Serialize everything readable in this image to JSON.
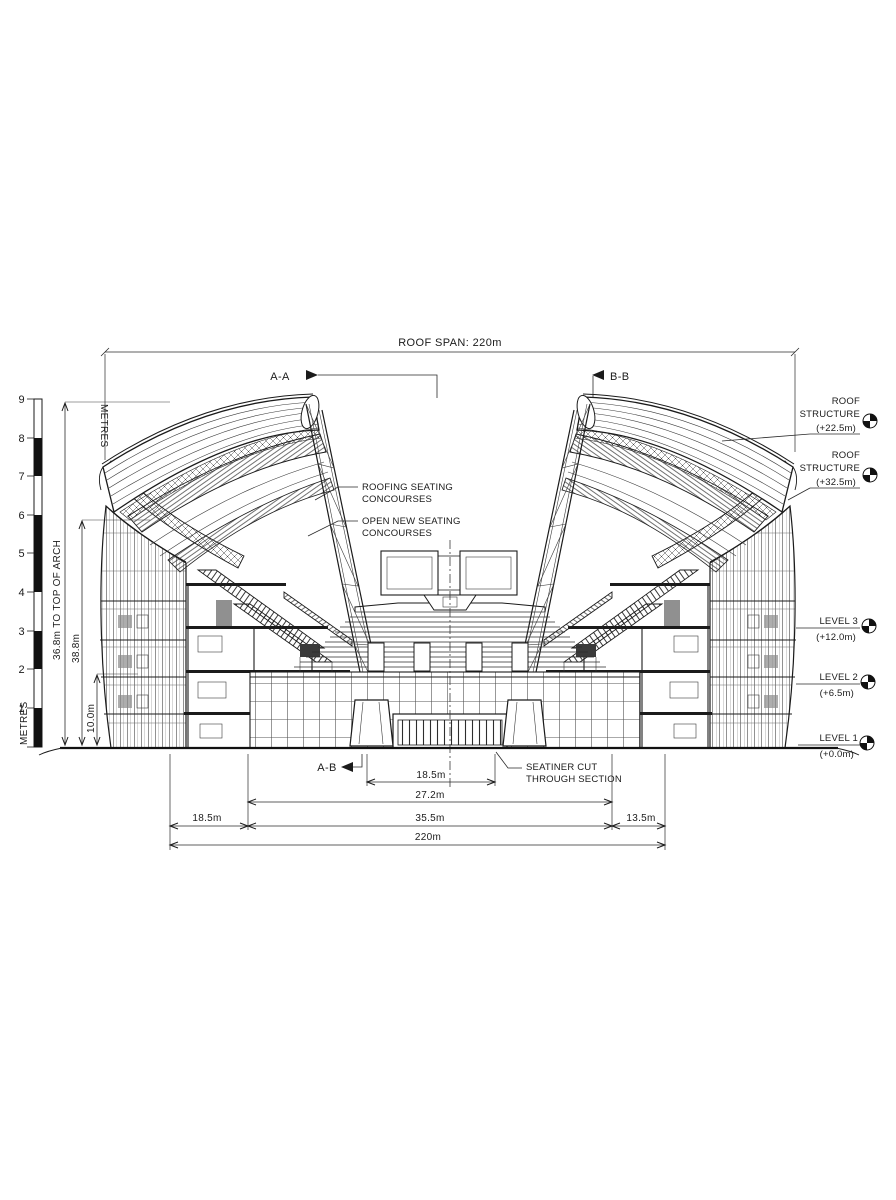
{
  "title_dimension": "ROOF SPAN: 220m",
  "section_markers": {
    "top_left": "A-A",
    "top_right": "B-B",
    "bottom": "A-B"
  },
  "scale_bar": {
    "label_top": "METRES",
    "label_bottom": "METRES",
    "ticks": [
      "9",
      "8",
      "7",
      "6",
      "5",
      "4",
      "3",
      "2",
      "1"
    ]
  },
  "vertical_dimensions": {
    "arch": "36.8m TO TOP OF ARCH",
    "overall": "38.8m",
    "lower": "10.0m"
  },
  "callouts": {
    "roof_upper": {
      "line1": "ROOF",
      "line2": "STRUCTURE",
      "elevation": "(+22.5m)"
    },
    "roof_lower": {
      "line1": "ROOF",
      "line2": "STRUCTURE",
      "elevation": "(+32.5m)"
    },
    "level3": {
      "name": "LEVEL 3",
      "elevation": "(+12.0m)"
    },
    "level2": {
      "name": "LEVEL 2",
      "elevation": "(+6.5m)"
    },
    "level1": {
      "name": "LEVEL 1",
      "elevation": "(+0.0m)"
    }
  },
  "annotations": {
    "roofing_seating": {
      "line1": "ROOFING SEATING",
      "line2": "CONCOURSES"
    },
    "open_seating": {
      "line1": "OPEN NEW SEATING",
      "line2": "CONCOURSES"
    },
    "seating_cut": {
      "line1": "SEATINER CUT",
      "line2": "THROUGH SECTION"
    }
  },
  "bottom_dimensions": {
    "inner": "18.5m",
    "mid": "27.2m",
    "left": "18.5m",
    "center": "35.5m",
    "right": "13.5m",
    "overall": "220m"
  }
}
